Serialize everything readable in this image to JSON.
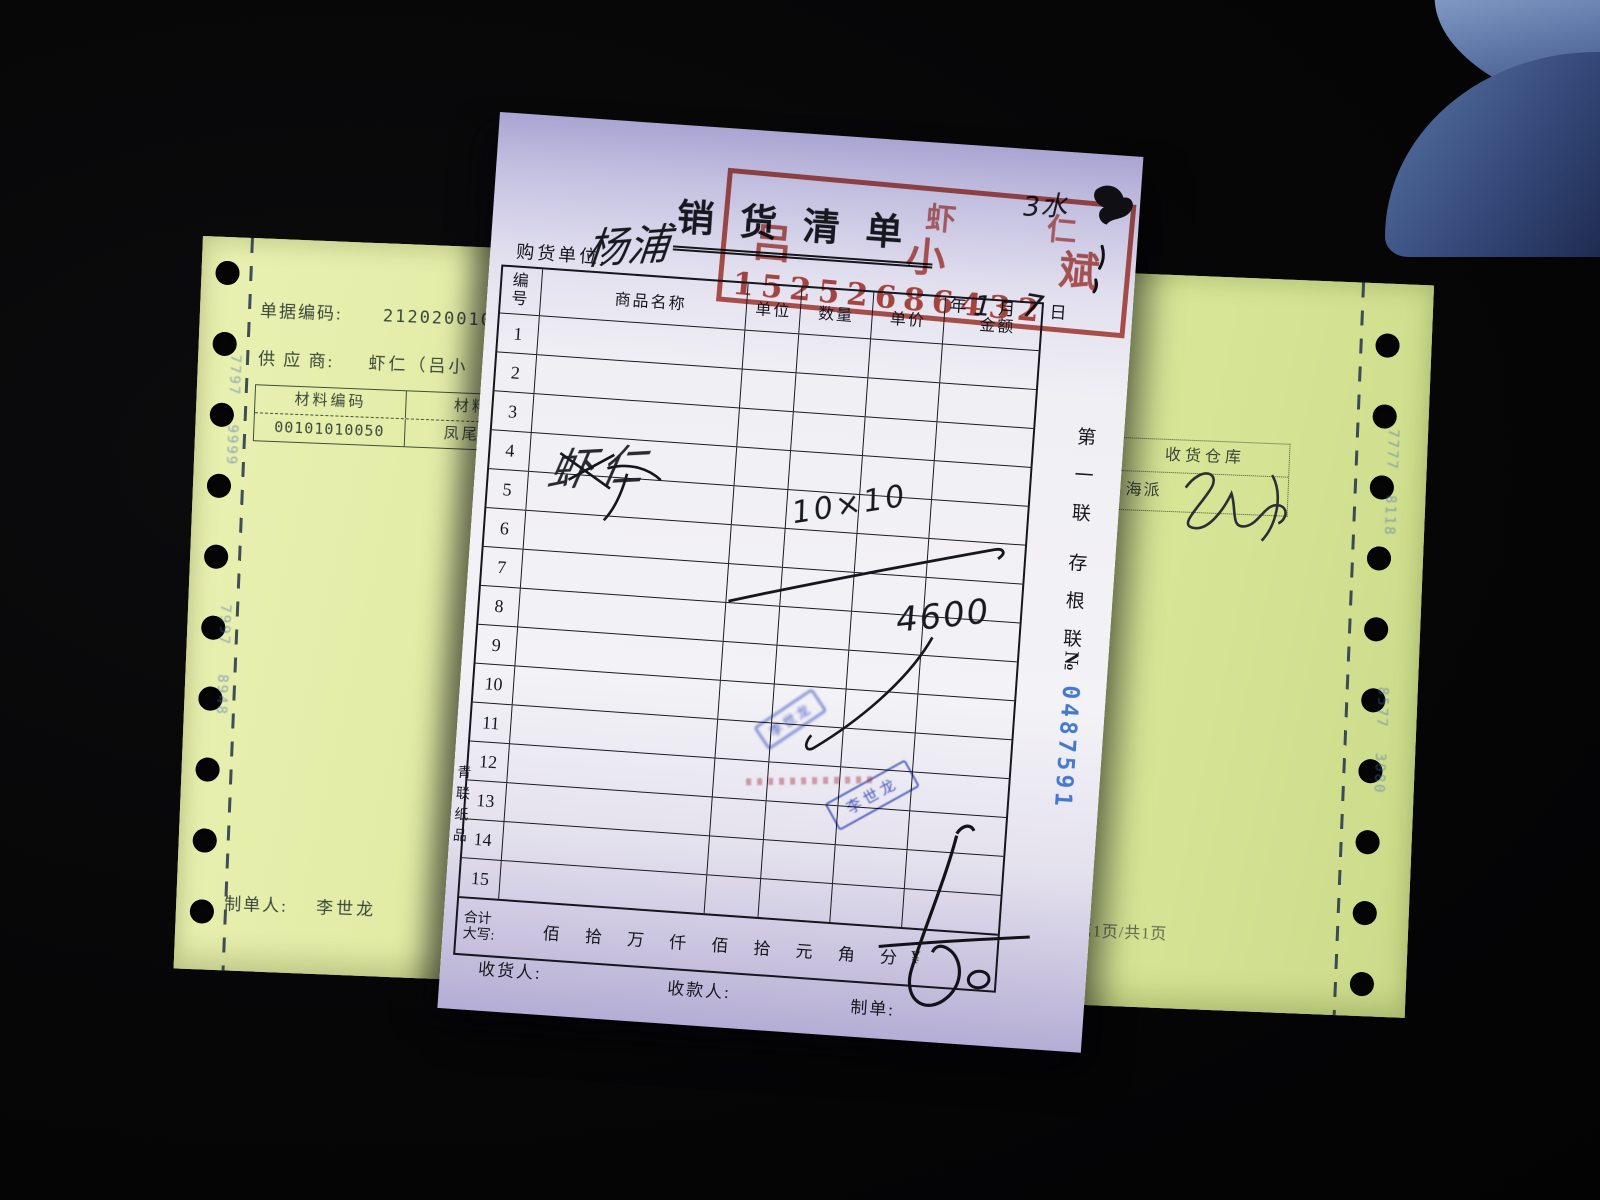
{
  "receipt": {
    "title": "销货清单",
    "buyer_label": "购货单位:",
    "buyer_value": "杨浦",
    "top_note": "3水",
    "date": {
      "year_label": "年",
      "month_value": "1",
      "month_label": "月",
      "day_value": "7",
      "day_label": "日"
    },
    "red_stamp": {
      "line1": "虾 仁",
      "line2": "吕小斌",
      "line3": "15252686432",
      "color": "#ac2e22"
    },
    "table": {
      "headers": {
        "col_no": "编号",
        "col_name": "商品名称",
        "col_unit": "单位",
        "col_qty": "数量",
        "col_price": "单价",
        "col_amount": "金额"
      },
      "row_numbers": [
        "1",
        "2",
        "3",
        "4",
        "5",
        "6",
        "7",
        "8",
        "9",
        "10",
        "11",
        "12",
        "13",
        "14",
        "15"
      ]
    },
    "handwriting": {
      "product": "虾仁",
      "quantity": "10×10",
      "amount": "4600"
    },
    "blue_stamps": {
      "small_stamp_text": "李世龙",
      "name_stamp_text": "李世龙",
      "color": "#3a52c6"
    },
    "side_text": {
      "copy_line1": "第一联",
      "copy_line2": "存根联",
      "no_label": "№",
      "serial": "0487591",
      "serial_color": "#4479cf"
    },
    "printer_mark": "青联纸品",
    "total_row": {
      "label_line1": "合计",
      "label_line2": "大写:",
      "units": [
        "佰",
        "拾",
        "万",
        "仟",
        "佰",
        "拾",
        "元",
        "角",
        "分"
      ],
      "currency": "¥"
    },
    "footer": {
      "receiver_label": "收货人:",
      "cashier_label": "收款人:",
      "maker_label": "制单:"
    }
  },
  "yellow_form": {
    "doc_code_label": "单据编码:",
    "doc_code_value": "21202001070",
    "supplier_label": "供 应 商:",
    "supplier_value": "虾仁（吕小",
    "material_table": {
      "header_code": "材料编码",
      "header_name": "材料名",
      "code": "00101010050",
      "name": "凤尾虾仁"
    },
    "maker_label": "制单人:",
    "maker_value": "李世龙",
    "warehouse_box": {
      "title": "收货仓库",
      "value": "海派"
    },
    "page_info": "第1页/共1页",
    "tractor_marks_left": [
      "7797",
      "9999",
      "7997",
      "8948"
    ],
    "tractor_marks_right": [
      "7777",
      "8118",
      "8577",
      "3080"
    ]
  }
}
